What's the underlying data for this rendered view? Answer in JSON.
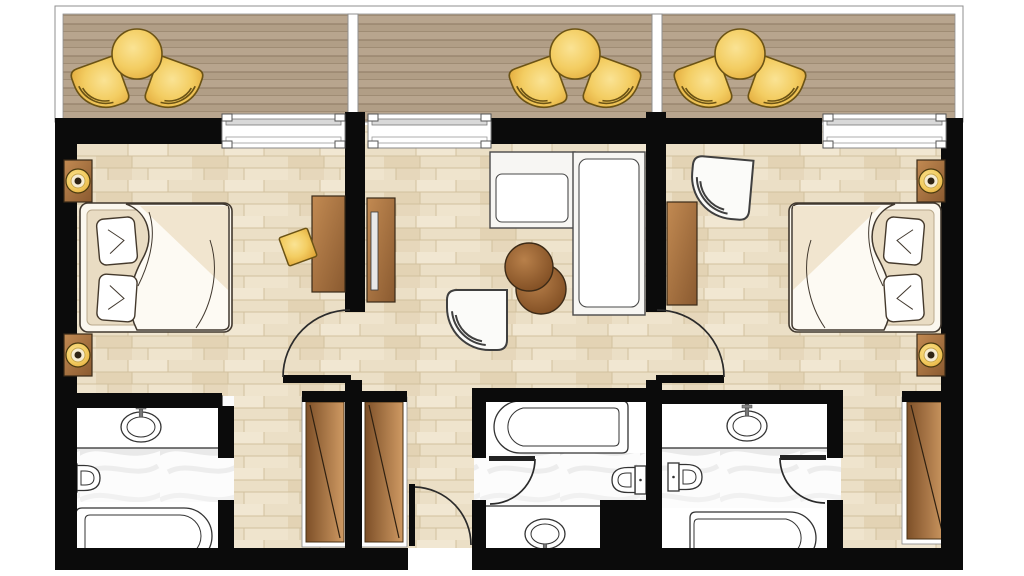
{
  "page": {
    "title": "Two-bedroom hotel suite floor plan",
    "type": "architectural-floor-plan-top-view"
  },
  "palette": {
    "wall": "#0b0b0b",
    "outline": "#3a3a3a",
    "floor_wood": "#ebdfc6",
    "floor_wood_line": "#d2c09e",
    "deck": "#b6a38c",
    "deck_line": "#94816a",
    "marble": "#fcfcfc",
    "gold_light": "#fae394",
    "gold_dark": "#e2a93a",
    "gold_stroke": "#6b5315",
    "brown_light": "#c28a52",
    "brown_dark": "#8a5a30",
    "table_brown": "#a9713f",
    "linen": "#e9dcc3",
    "paper": "#ffffff"
  },
  "rooms": [
    {
      "id": "balcony",
      "sections": 3,
      "furniture": [
        "patio-table",
        "patio-chair",
        "patio-chair",
        "patio-table",
        "patio-chair",
        "patio-chair",
        "patio-table",
        "patio-chair",
        "patio-chair"
      ],
      "features": [
        "wood-decking",
        "railing",
        "privacy-divider",
        "privacy-divider"
      ]
    },
    {
      "id": "bedroom-left",
      "furniture": [
        "double-bed",
        "pillow",
        "pillow",
        "duvet",
        "nightstand",
        "table-lamp",
        "nightstand",
        "table-lamp",
        "desk",
        "gold-stool"
      ],
      "features": [
        "sliding-glass-door",
        "swing-door"
      ]
    },
    {
      "id": "living-room",
      "furniture": [
        "tv-console",
        "tv",
        "sofa-seat",
        "sofa-chaise",
        "round-side-table",
        "round-side-table",
        "armchair"
      ],
      "features": [
        "sliding-glass-door"
      ]
    },
    {
      "id": "bedroom-right",
      "furniture": [
        "double-bed",
        "pillow",
        "pillow",
        "duvet",
        "nightstand",
        "table-lamp",
        "nightstand",
        "table-lamp",
        "dresser",
        "armchair"
      ],
      "features": [
        "sliding-glass-door",
        "swing-door"
      ]
    },
    {
      "id": "bathroom-left",
      "furniture": [
        "vanity-counter",
        "sink",
        "toilet",
        "bathtub"
      ],
      "features": [
        "marble-floor",
        "open-doorway"
      ]
    },
    {
      "id": "entry-hall",
      "furniture": [
        "wardrobe",
        "wardrobe"
      ],
      "features": [
        "entry-door"
      ]
    },
    {
      "id": "bathroom-middle",
      "furniture": [
        "bathtub",
        "toilet",
        "vanity-counter",
        "sink",
        "service-duct"
      ],
      "features": [
        "marble-floor",
        "swing-door"
      ]
    },
    {
      "id": "bathroom-right",
      "furniture": [
        "vanity-counter",
        "sink",
        "toilet",
        "bathtub"
      ],
      "features": [
        "marble-floor",
        "swing-door"
      ]
    },
    {
      "id": "corridor-right",
      "furniture": [
        "wardrobe"
      ],
      "features": []
    }
  ],
  "openings": {
    "sliding_windows": 3,
    "swing_doors": 5,
    "open_doorways": 1
  }
}
